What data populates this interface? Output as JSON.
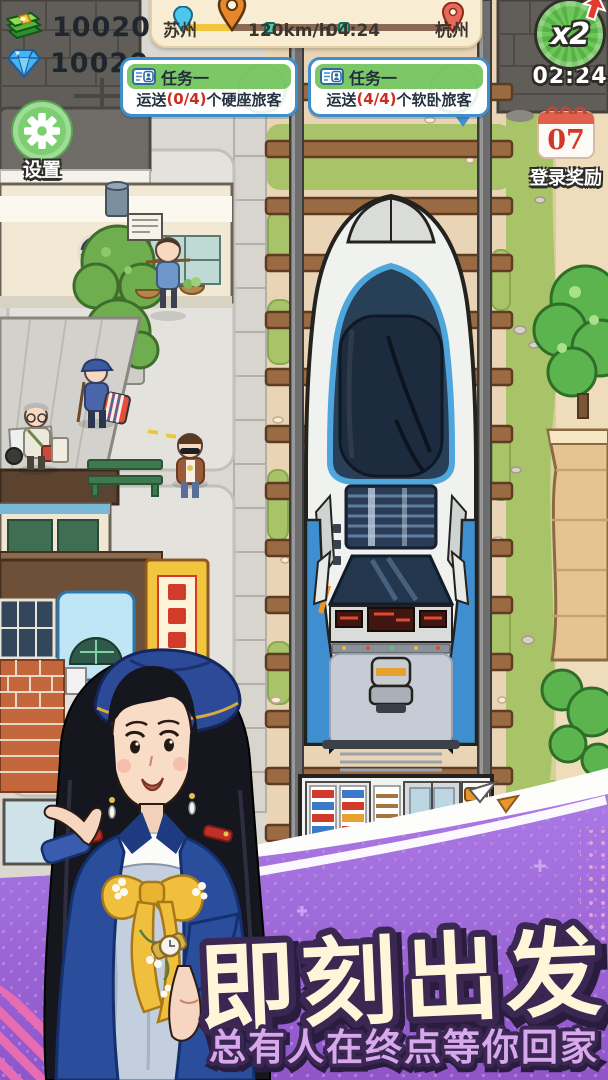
{
  "hud": {
    "currencies": [
      {
        "icon": "cash-icon",
        "value": "10020"
      },
      {
        "icon": "diamond-icon",
        "value": "10020"
      }
    ],
    "route": {
      "from": "苏州",
      "speed": "120km/h",
      "time": "04:24",
      "to": "杭州"
    },
    "boost": {
      "label": "x2",
      "timer": "02:24"
    },
    "tasks": [
      {
        "title": "任务一",
        "prefix": "运送",
        "progress": "(0/4)",
        "suffix": "个硬座旅客"
      },
      {
        "title": "任务一",
        "prefix": "运送",
        "progress": "(4/4)",
        "suffix": "个软卧旅客"
      }
    ],
    "settings": {
      "label": "设置"
    },
    "login_reward": {
      "day": "07",
      "label": "登录奖励"
    }
  },
  "banner": {
    "headline": "即刻出发",
    "subline": "总有人在终点等你回家"
  },
  "colors": {
    "task_header_green": "#7cc866",
    "task_border_blue": "#3d8ec9",
    "progress_red": "#cc2b20",
    "boost_green": "#63b94e",
    "route_card_cream": "#f8edd2",
    "banner_purple": "#9a66d6",
    "headline_cream": "#fdf6d8",
    "subline_lilac": "#d8a8ec",
    "grass_green": "#a9c368",
    "gravel_tan": "#e9d5b6",
    "train_blue": "#3f8fd0"
  }
}
